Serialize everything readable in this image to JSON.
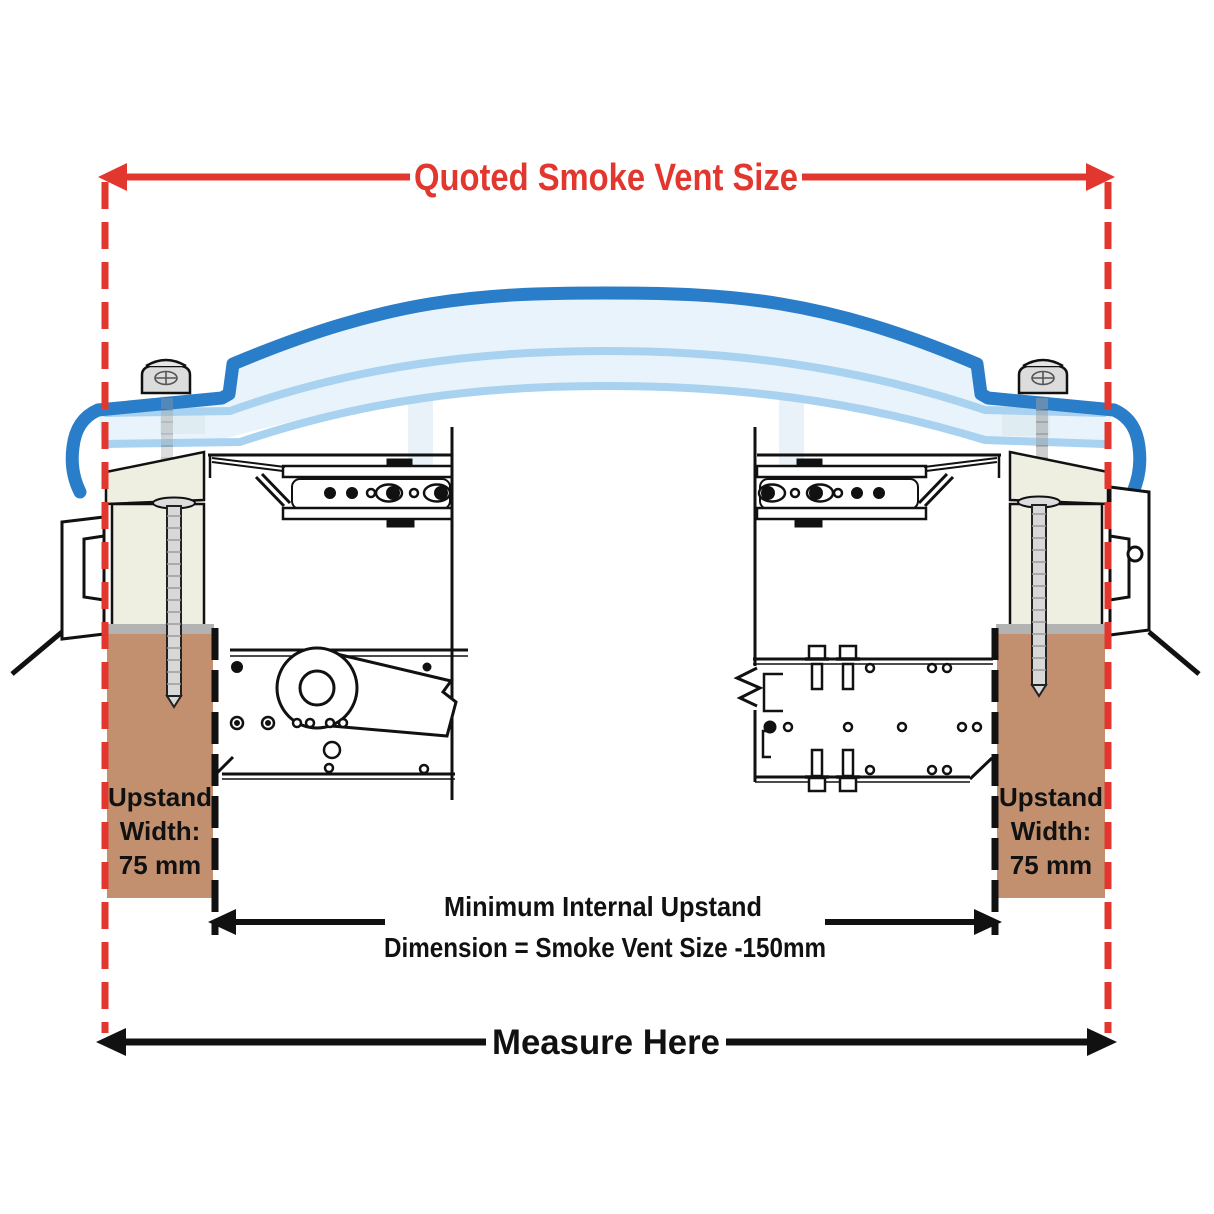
{
  "annotations": {
    "quoted_size_label": "Quoted Smoke Vent Size",
    "internal_dimension": {
      "line1": "Minimum Internal Upstand",
      "line2": "Dimension = Smoke Vent Size -150mm"
    },
    "measure_here_label": "Measure Here",
    "left_upstand": {
      "line1": "Upstand",
      "line2": "Width:",
      "line3": "75 mm"
    },
    "right_upstand": {
      "line1": "Upstand",
      "line2": "Width:",
      "line3": "75 mm"
    }
  },
  "colors": {
    "annotation_red": "#e2372e",
    "dome_blue": "#2a7dc9",
    "glazing_line_blue": "#a8d2f0",
    "glazing_fill": "#e8f3fb",
    "kerb_cream": "#eeeee1",
    "upstand_brown": "#c2906e",
    "cap_gray": "#b3b3b3",
    "line_black": "#111111"
  }
}
